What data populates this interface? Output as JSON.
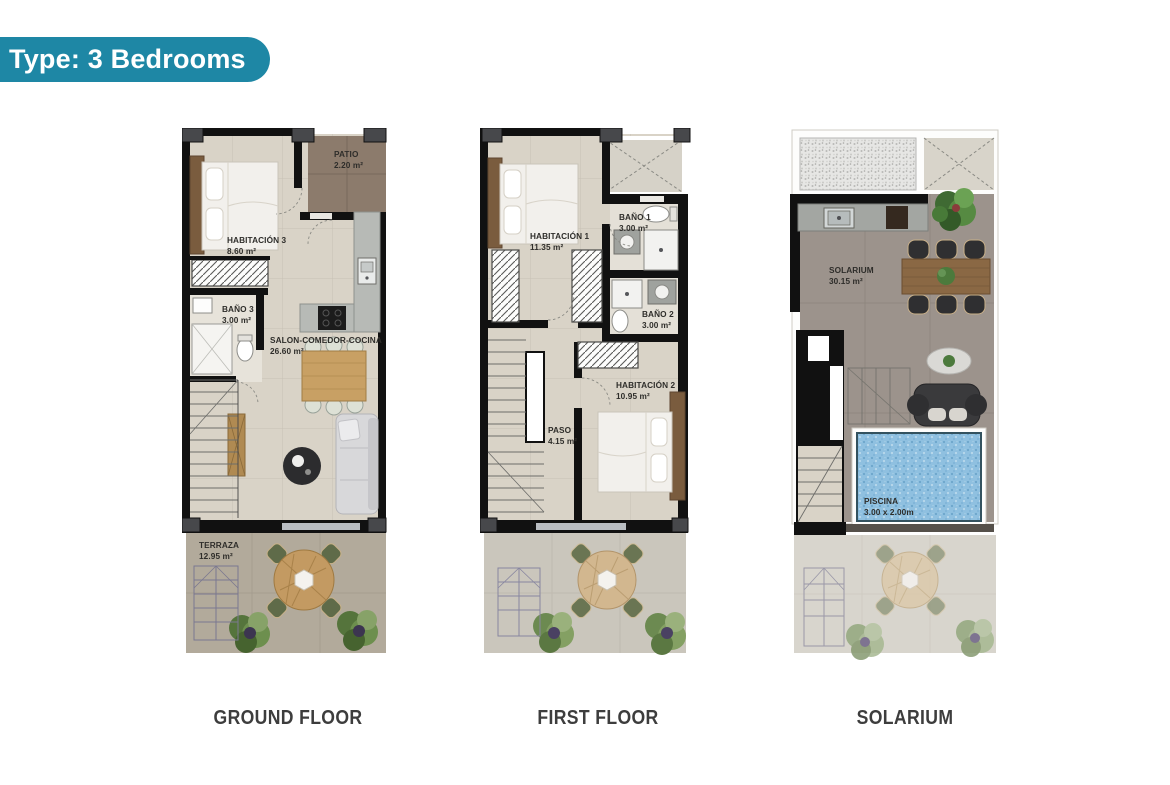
{
  "badge": {
    "label": "Type: 3 Bedrooms"
  },
  "plans": {
    "ground": {
      "caption": "GROUND FLOOR",
      "rooms": {
        "habitacion3": {
          "name": "HABITACIÓN 3",
          "area": "8.60 m²"
        },
        "patio": {
          "name": "PATIO",
          "area": "2.20 m²"
        },
        "bano3": {
          "name": "BAÑO 3",
          "area": "3.00 m²"
        },
        "salon": {
          "name": "SALON-COMEDOR-COCINA",
          "area": "26.60 m²"
        },
        "terraza": {
          "name": "TERRAZA",
          "area": "12.95 m²"
        }
      }
    },
    "first": {
      "caption": "FIRST FLOOR",
      "rooms": {
        "habitacion1": {
          "name": "HABITACIÓN 1",
          "area": "11.35 m²"
        },
        "bano1": {
          "name": "BAÑO 1",
          "area": "3.00 m²"
        },
        "bano2": {
          "name": "BAÑO 2",
          "area": "3.00 m²"
        },
        "habitacion2": {
          "name": "HABITACIÓN 2",
          "area": "10.95 m²"
        },
        "paso": {
          "name": "PASO",
          "area": "4.15 m²"
        }
      }
    },
    "solarium": {
      "caption": "SOLARIUM",
      "rooms": {
        "solarium": {
          "name": "SOLARIUM",
          "area": "30.15 m²"
        },
        "piscina": {
          "name": "PISCINA",
          "area": "3.00 x 2.00m"
        }
      }
    }
  },
  "colors": {
    "badge_teal": "#1e87a5",
    "wall_black": "#111111",
    "pillar_gray": "#47484b",
    "interior_floor": "#d9d3c7",
    "patio_brown": "#8c7b6c",
    "terrace_ground": "#b2aa9b",
    "terrace_first": "#cac6bc",
    "terrace_solarium": "#d8d5cd",
    "solarium_floor": "#9c938c",
    "pool_blue": "#8fc0e0",
    "wood": "#c8a064",
    "label_text": "#2e2d2a"
  }
}
